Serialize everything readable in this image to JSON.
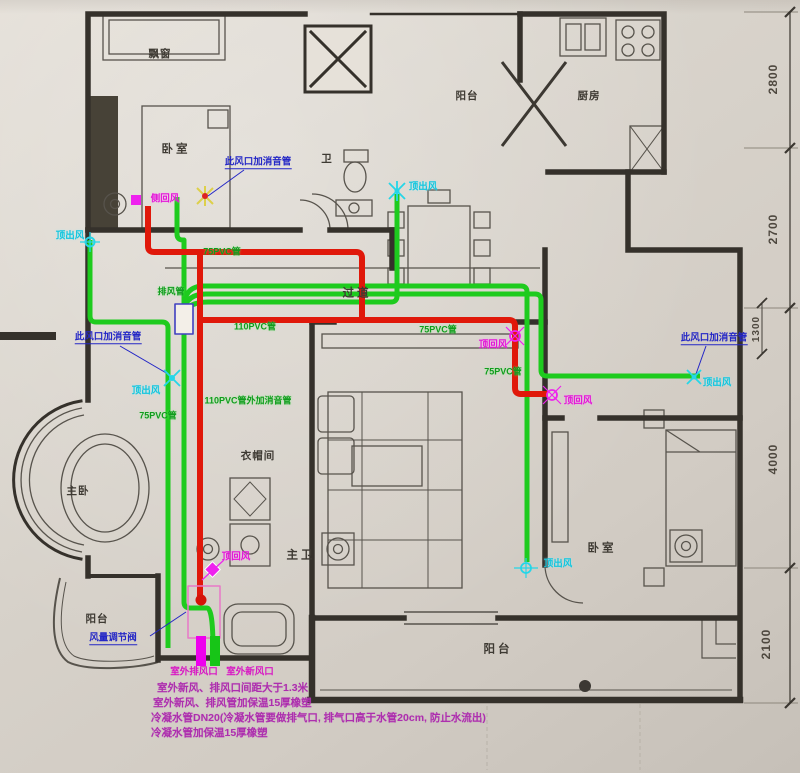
{
  "rooms": {
    "bay_window": "飘窗",
    "bedroom_topleft": "卧室",
    "bath_small": "卫",
    "balcony_top": "阳台",
    "kitchen": "厨房",
    "corridor": "过道",
    "closet": "衣帽间",
    "master_bedroom": "主卧",
    "master_bath": "主卫",
    "bedroom_right": "卧室",
    "balcony_left": "阳台",
    "balcony_bottom": "阳台"
  },
  "ducts": {
    "side_return": "侧回风",
    "silencer_top": "此风口加消音管",
    "silencer_left": "此风口加消音管",
    "silencer_right": "此风口加消音管",
    "supply_left_top": "顶出风",
    "supply_dining": "顶出风",
    "supply_mid_left": "顶出风",
    "supply_right": "顶出风",
    "supply_bedroom_right": "顶出风",
    "return_corridor": "顶回风",
    "return_right": "顶回风",
    "return_master_bath": "顶回风",
    "pipe75_top": "75PVC管",
    "exhaust_pipe": "排风管",
    "pipe110": "110PVC管",
    "pipe75_corridor": "75PVC管",
    "pipe75_right": "75PVC管",
    "pipe110_silencer": "110PVC管外加消音管",
    "pipe75_left": "75PVC管",
    "damper": "风量调节阀"
  },
  "ports": {
    "outdoor_exhaust": "室外排风口",
    "outdoor_fresh": "室外新风口"
  },
  "notes": {
    "line1": "室外新风、排风口间距大于1.3米",
    "line2": "室外新风、排风管加保温15厚橡塑",
    "line3": "冷凝水管DN20(冷凝水管要做排气口, 排气口高于水管20cm, 防止水流出)",
    "line4": "冷凝水管加保温15厚橡塑"
  },
  "dimensions": {
    "d1": "2800",
    "d2": "2700",
    "d3": "1300",
    "d4": "4000",
    "d5": "2100"
  },
  "colors": {
    "supply_green": "#1ecb1e",
    "exhaust_red": "#e0180a",
    "marker_magenta": "#ee22ee",
    "marker_cyan": "#25d6e8",
    "annotation_blue": "#2326c6",
    "note_magenta": "#ad2fae",
    "wall": "#35312b"
  }
}
